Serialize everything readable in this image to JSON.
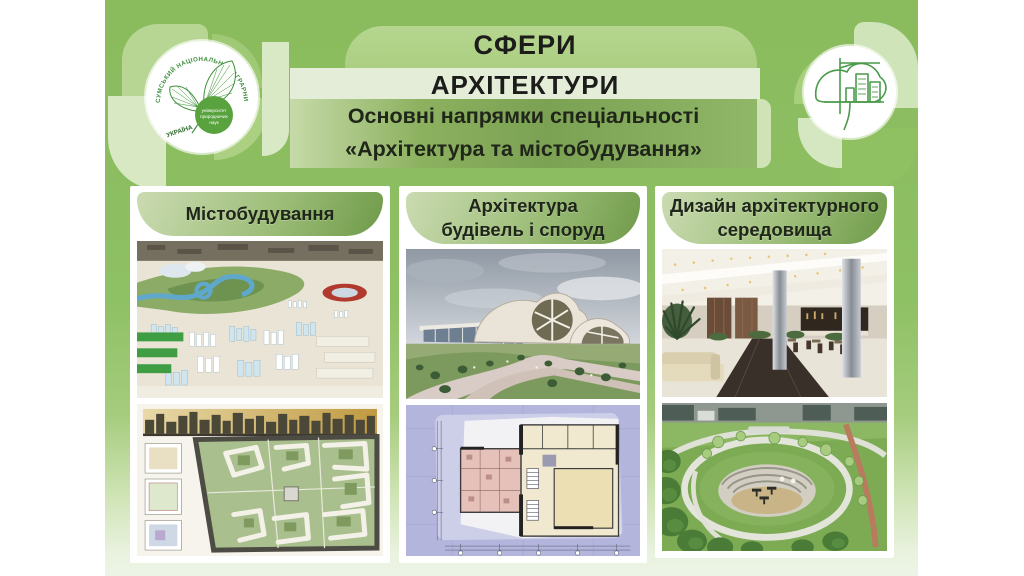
{
  "header": {
    "title_line1": "СФЕРИ",
    "title_line2": "АРХІТЕКТУРИ",
    "subtitle_line1": "Основні напрямки спеціальності",
    "subtitle_line2": "«Архітектура та містобудування»"
  },
  "logo_left": {
    "ring_text": "СУМСЬКИЙ НАЦІОНАЛЬНИЙ АГРАРНИЙ УНІВЕРСИТЕТ",
    "country_text": "УКРАЇНА",
    "inner_line1": "університет",
    "inner_line2": "природничих",
    "inner_line3": "наук"
  },
  "columns": [
    {
      "title_line1": "Містобудування",
      "title_line2": "",
      "image_top": "city-model-aerial-photo",
      "image_bottom": "urban-master-plan-drawing"
    },
    {
      "title_line1": "Архітектура",
      "title_line2": "будівель і споруд",
      "image_top": "modern-building-render",
      "image_bottom": "architectural-floor-plan"
    },
    {
      "title_line1": "Дизайн архітектурного",
      "title_line2": "середовища",
      "image_top": "interior-lobby-photo",
      "image_bottom": "green-roof-park-photo"
    }
  ],
  "colors": {
    "panel_green": "#8cbd60",
    "panel_fade": "#eaf3e2",
    "banner_pill": "#a9cd7e",
    "light_band": "#e4edd8",
    "subtitle_band": "#7ba152",
    "card_header_light": "#c8d9ae",
    "card_header_dark": "#6f9a49",
    "text_dark": "#1e1e1c",
    "logo_green": "#3f8f3f"
  }
}
